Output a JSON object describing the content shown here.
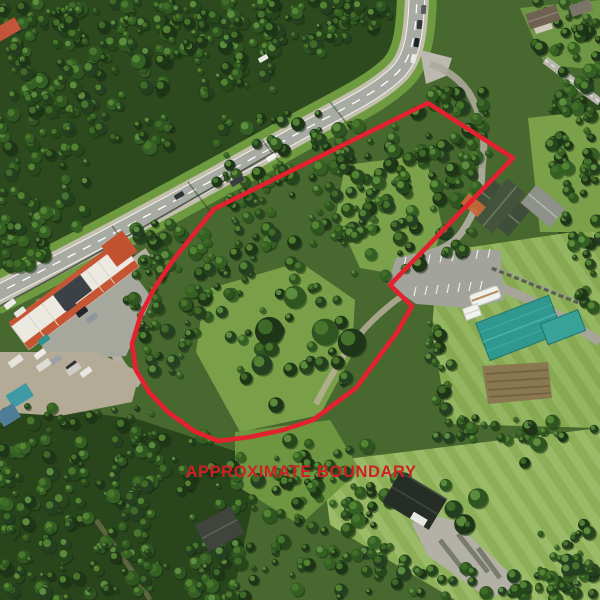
{
  "photo": {
    "type": "aerial-drone-photo",
    "subject": "forested property parcel beside a highway with commercial strip mall, chalet house, teal-roof building and neighboring homes"
  },
  "annotation": {
    "label": "APPROXIMATE BOUNDARY",
    "label_color": "#cf2026",
    "line_color": "#e4212e",
    "boundary_points": "428,103 513,158 390,285 412,306 398,331 356,388 313,420 283,430 250,437 218,441 194,431 168,412 149,392 136,370 132,344 141,314 154,289 171,263 189,240 214,209"
  }
}
